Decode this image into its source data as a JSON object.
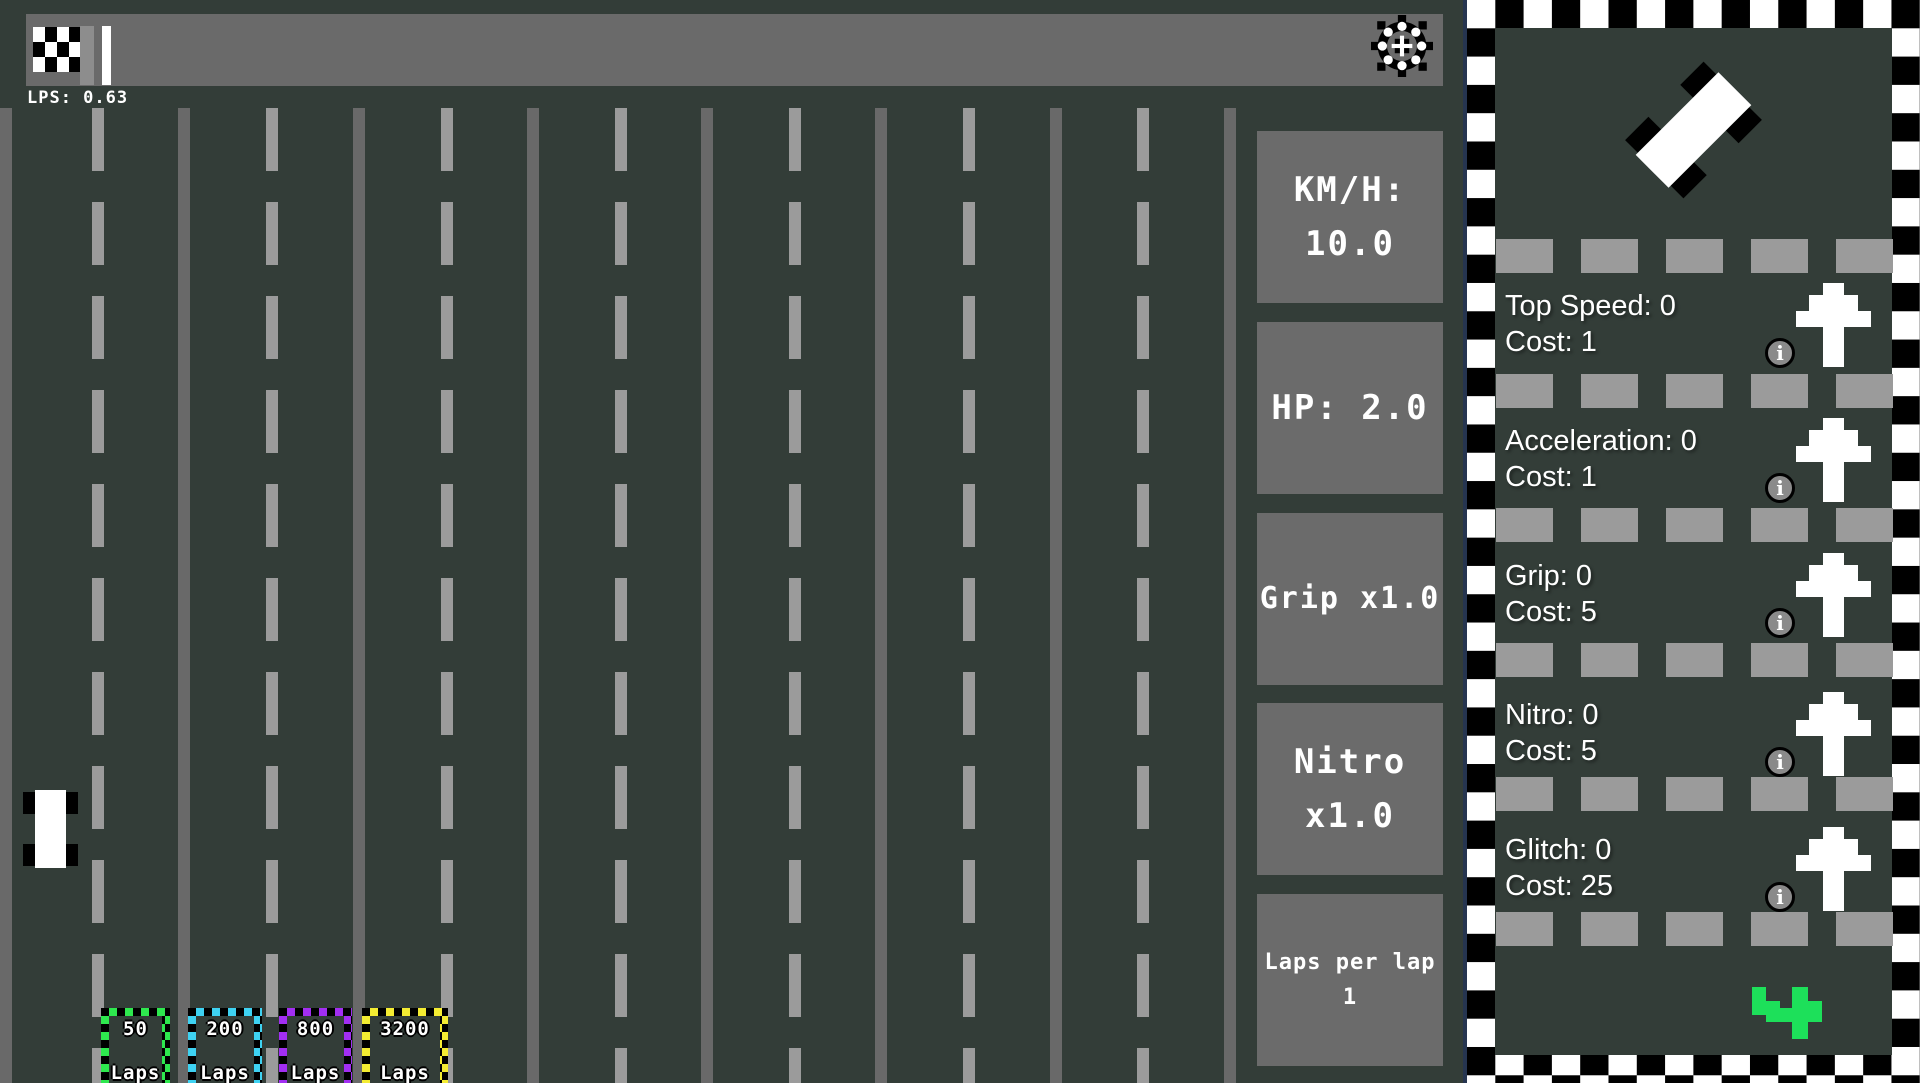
{
  "hud": {
    "lps_label": "LPS: 0.63"
  },
  "stats": {
    "kmh": {
      "line1": "KM/H:",
      "line2": "10.0"
    },
    "hp": {
      "line1": "HP: 2.0"
    },
    "grip": {
      "line1": "Grip x1.0"
    },
    "nitro": {
      "line1": "Nitro",
      "line2": "x1.0"
    },
    "laps_per_lap": {
      "line1": "Laps per lap",
      "line2": "1"
    }
  },
  "lap_badges": [
    {
      "value": "50",
      "unit": "Laps",
      "border_color": "#2ee84e"
    },
    {
      "value": "200",
      "unit": "Laps",
      "border_color": "#3ed2f2"
    },
    {
      "value": "800",
      "unit": "Laps",
      "border_color": "#a22ef2"
    },
    {
      "value": "3200",
      "unit": "Laps",
      "border_color": "#f4ec32"
    }
  ],
  "upgrades": [
    {
      "label": "Top Speed: 0",
      "cost_label": "Cost: 1"
    },
    {
      "label": "Acceleration: 0",
      "cost_label": "Cost: 1"
    },
    {
      "label": "Grip: 0",
      "cost_label": "Cost: 5"
    },
    {
      "label": "Nitro: 0",
      "cost_label": "Cost: 5"
    },
    {
      "label": "Glitch: 0",
      "cost_label": "Cost: 25"
    }
  ],
  "icons": {
    "info_glyph": "i"
  },
  "colors": {
    "background": "#333d38",
    "progress_bar": "#6a6a6a",
    "progress_fill": "#8d8d8d",
    "stat_box": "#6b6b6b",
    "lane_solid": "#696969",
    "lane_dashed": "#9b9b9b",
    "pip": "#9b9b9b",
    "glitch_arrow_green": "#1de05a",
    "badge_green": "#2ee84e",
    "badge_cyan": "#3ed2f2",
    "badge_purple": "#a22ef2",
    "badge_yellow": "#f4ec32"
  }
}
